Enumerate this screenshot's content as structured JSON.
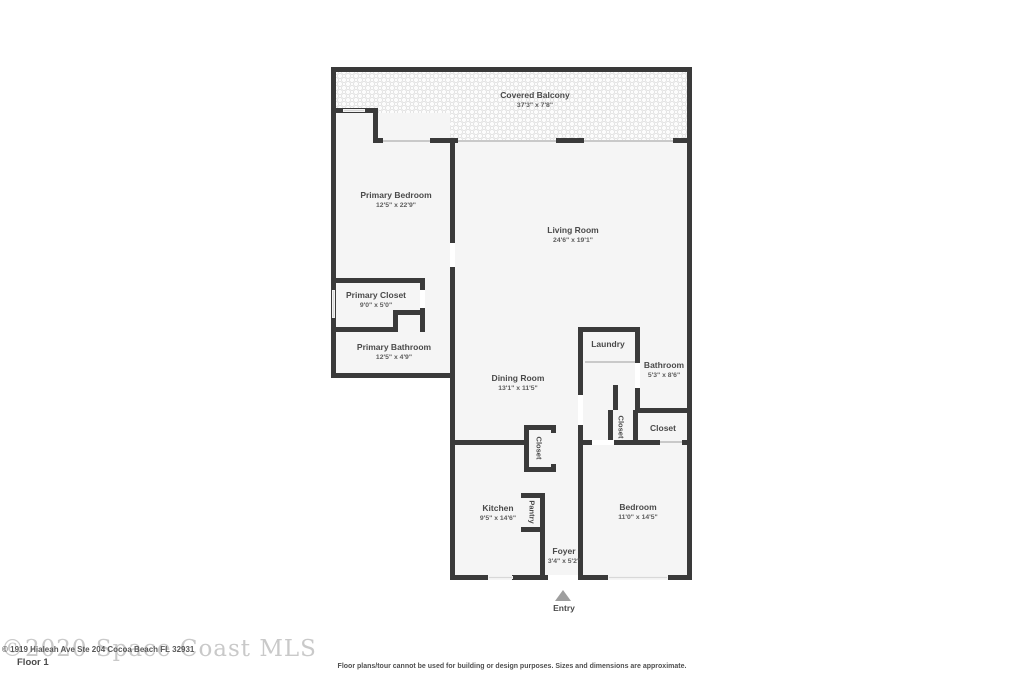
{
  "floor_plan": {
    "rooms": [
      {
        "id": "covered-balcony",
        "name": "Covered Balcony",
        "dims": "37'3\" x 7'8\""
      },
      {
        "id": "primary-bedroom",
        "name": "Primary Bedroom",
        "dims": "12'5\" x 22'9\""
      },
      {
        "id": "living-room",
        "name": "Living Room",
        "dims": "24'6\" x 19'1\""
      },
      {
        "id": "primary-closet",
        "name": "Primary Closet",
        "dims": "9'0\" x 5'0\""
      },
      {
        "id": "primary-bathroom",
        "name": "Primary Bathroom",
        "dims": "12'5\" x 4'9\""
      },
      {
        "id": "dining-room",
        "name": "Dining Room",
        "dims": "13'1\" x 11'5\""
      },
      {
        "id": "laundry",
        "name": "Laundry",
        "dims": ""
      },
      {
        "id": "bathroom",
        "name": "Bathroom",
        "dims": "5'3\" x 8'6\""
      },
      {
        "id": "hall-closet",
        "name": "Closet",
        "dims": ""
      },
      {
        "id": "bedroom-closet",
        "name": "Closet",
        "dims": ""
      },
      {
        "id": "dining-closet",
        "name": "Closet",
        "dims": ""
      },
      {
        "id": "kitchen",
        "name": "Kitchen",
        "dims": "9'5\" x 14'6\""
      },
      {
        "id": "pantry",
        "name": "Pantry",
        "dims": ""
      },
      {
        "id": "foyer",
        "name": "Foyer",
        "dims": "3'4\" x 5'2\""
      },
      {
        "id": "bedroom",
        "name": "Bedroom",
        "dims": "11'0\" x 14'5\""
      }
    ],
    "entry_label": "Entry",
    "floor_label": "Floor 1",
    "watermark": "©2020 Space Coast MLS",
    "address_text": "© 1919 Hialeah Ave Ste 204 Cocoa Beach FL 32931",
    "disclaimer": "Floor plans/tour cannot be used for building or design purposes. Sizes and dimensions are approximate.",
    "colors": {
      "wall": "#3a3a3a",
      "room_fill": "#f5f5f5",
      "window": "#d8d8d8",
      "label_text": "#4a4a4a",
      "watermark_text": "#c9c9c9",
      "entry_arrow": "#9e9e9e"
    }
  }
}
